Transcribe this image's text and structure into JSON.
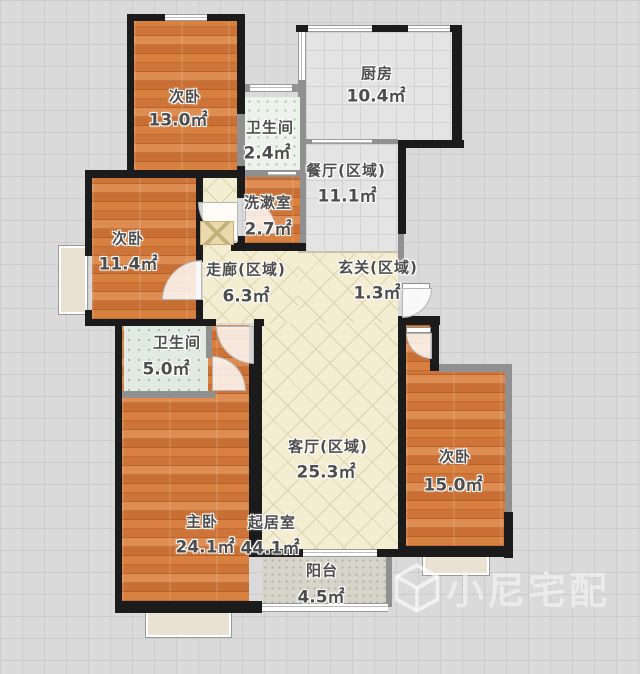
{
  "plan": {
    "title": "apartment-floor-plan",
    "rooms": [
      {
        "id": "bed1",
        "name": "次卧",
        "area": "13.0㎡"
      },
      {
        "id": "bath1",
        "name": "卫生间",
        "area": "2.4㎡"
      },
      {
        "id": "kitchen",
        "name": "厨房",
        "area": "10.4㎡"
      },
      {
        "id": "dining",
        "name": "餐厅(区域)",
        "area": "11.1㎡"
      },
      {
        "id": "wash",
        "name": "洗漱室",
        "area": "2.7㎡"
      },
      {
        "id": "bed2",
        "name": "次卧",
        "area": "11.4㎡"
      },
      {
        "id": "corridor",
        "name": "走廊(区域)",
        "area": "6.3㎡"
      },
      {
        "id": "entry",
        "name": "玄关(区域)",
        "area": "1.3㎡"
      },
      {
        "id": "bath2",
        "name": "卫生间",
        "area": "5.0㎡"
      },
      {
        "id": "living_zone",
        "name": "客厅(区域)",
        "area": "25.3㎡"
      },
      {
        "id": "master",
        "name": "主卧",
        "area": "24.1㎡"
      },
      {
        "id": "living",
        "name": "起居室",
        "area": "44.1㎡"
      },
      {
        "id": "bed3",
        "name": "次卧",
        "area": "15.0㎡"
      },
      {
        "id": "balcony",
        "name": "阳台",
        "area": "4.5㎡"
      }
    ],
    "watermark": {
      "text": "小尼宅配"
    },
    "colors": {
      "wall": "#1b1b1b",
      "interior_wall": "#909090",
      "wood_floor": "#d27a3e",
      "tile_floor": "#e4e4e4",
      "bath_tile": "#e8efe8",
      "hall_tile": "#f3edd2",
      "balcony_tile": "#d7d4ca",
      "background": "#dadada"
    }
  }
}
